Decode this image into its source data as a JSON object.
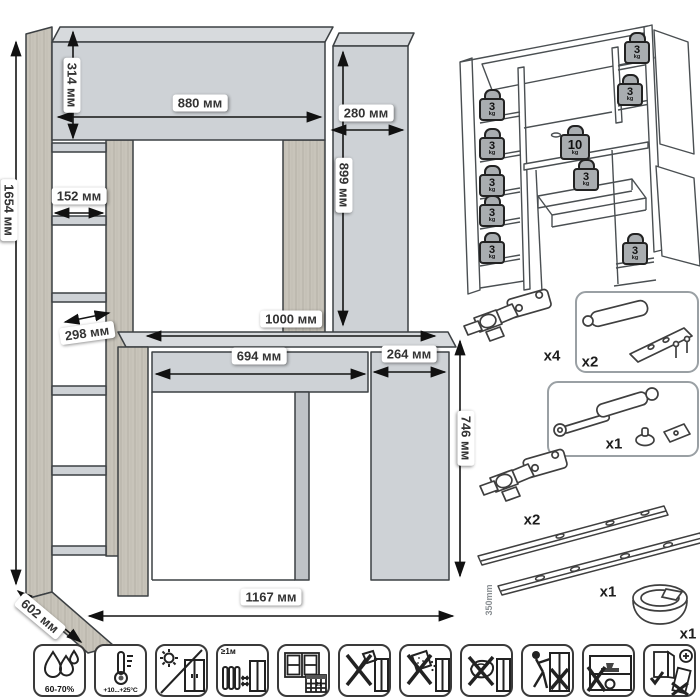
{
  "main_drawing": {
    "dims": {
      "height_total": "1654 мм",
      "hutch_height": "314 мм",
      "hutch_width": "880 мм",
      "side_width": "280 мм",
      "side_height": "899 мм",
      "shelf_width": "152 мм",
      "shelf_depth": "298 мм",
      "desktop_width": "1000 мм",
      "drawer_width": "694 мм",
      "cabinet_width": "264 мм",
      "desk_height": "746 мм",
      "depth": "602 мм",
      "width_total": "1167 мм"
    }
  },
  "load_diagram": {
    "weights": [
      {
        "value": "3",
        "unit": "kg",
        "spot": "hutch-top-right"
      },
      {
        "value": "3",
        "unit": "kg",
        "spot": "hutch-right-shelf"
      },
      {
        "value": "3",
        "unit": "kg",
        "spot": "left-shelf-1"
      },
      {
        "value": "3",
        "unit": "kg",
        "spot": "left-shelf-2"
      },
      {
        "value": "3",
        "unit": "kg",
        "spot": "left-shelf-3"
      },
      {
        "value": "3",
        "unit": "kg",
        "spot": "left-shelf-4"
      },
      {
        "value": "3",
        "unit": "kg",
        "spot": "left-shelf-5"
      },
      {
        "value": "10",
        "unit": "kg",
        "spot": "desktop"
      },
      {
        "value": "3",
        "unit": "kg",
        "spot": "drawer"
      },
      {
        "value": "3",
        "unit": "kg",
        "spot": "lower-cabinet"
      }
    ]
  },
  "hardware": [
    {
      "item": "corner-hinge",
      "qty": "x4"
    },
    {
      "item": "door-damper-with-screws",
      "qty": "x2"
    },
    {
      "item": "gas-lift-strut",
      "qty": "x1"
    },
    {
      "item": "hinge",
      "qty": "x2"
    },
    {
      "item": "drawer-slides",
      "qty": "x1",
      "size": "350mm"
    },
    {
      "item": "cable-grommet",
      "qty": "x1"
    }
  ],
  "care_icons": [
    {
      "icon": "humidity-drops",
      "label": "60-70%"
    },
    {
      "icon": "temperature-range",
      "label": "+10...+25°C"
    },
    {
      "icon": "no-direct-sunlight",
      "label": ""
    },
    {
      "icon": "distance-from-heat",
      "label": "≥1м"
    },
    {
      "icon": "ventilation-calendar",
      "label": "21"
    },
    {
      "icon": "no-sharp-tools",
      "label": ""
    },
    {
      "icon": "no-abrasive-cleaners",
      "label": ""
    },
    {
      "icon": "no-wet-cloth",
      "label": ""
    },
    {
      "icon": "no-dragging",
      "label": ""
    },
    {
      "icon": "no-overload",
      "label": ""
    },
    {
      "icon": "secure-to-wall",
      "label": ""
    }
  ]
}
